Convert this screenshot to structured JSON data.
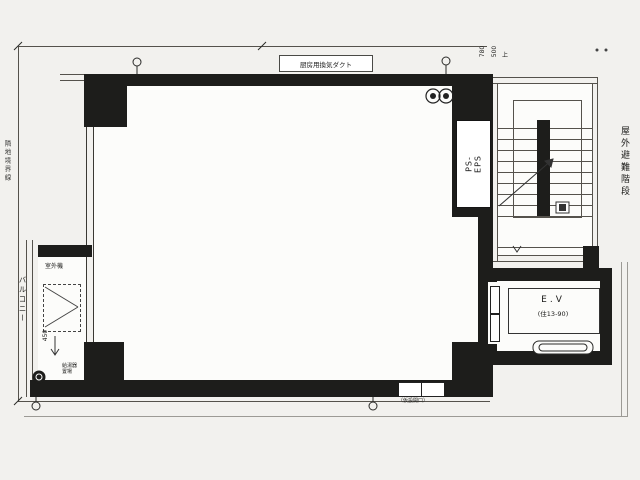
{
  "labels": {
    "duct": "厨房用換気ダクト",
    "ps_eps": "PS-EPS",
    "evac_stair": "屋外避難階段",
    "boundary": "隣地境界線",
    "balcony": "バルコニー",
    "outdoor_unit": "室外機",
    "dim_450": "450",
    "water_heater_1": "給湯器",
    "water_heater_2": "置場",
    "ev": "E.V",
    "ev_capacity": "(住13-90)",
    "wall_opening": "（仮設開口）",
    "dim_780": "780",
    "dim_500": "500",
    "dim_up": "上"
  },
  "colors": {
    "wall": "#1d1d1b",
    "line": "#55524c",
    "paper": "#f2f1ee",
    "interior": "#fcfcfa"
  }
}
